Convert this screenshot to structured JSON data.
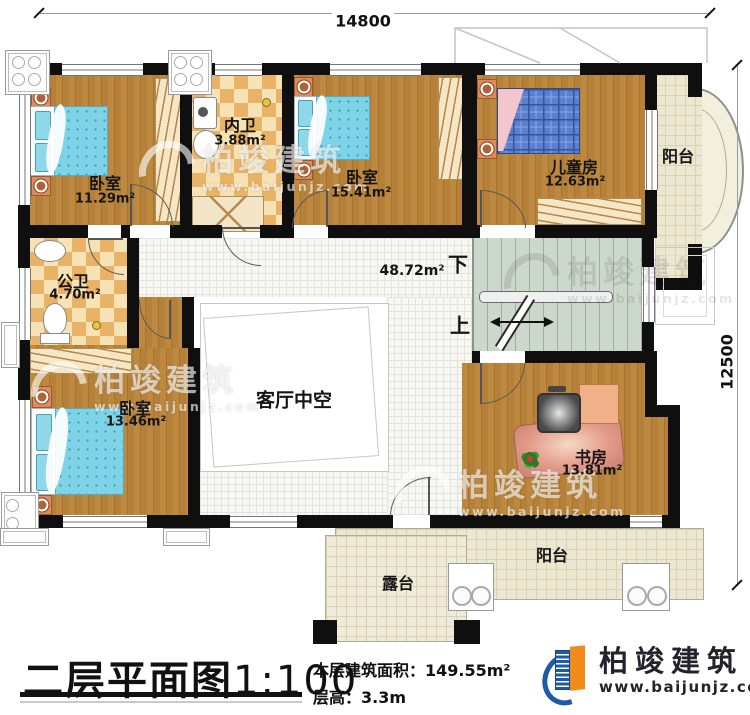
{
  "dimensions": {
    "width_mm": "14800",
    "height_mm": "12500"
  },
  "rooms": {
    "bedroom1": {
      "name": "卧室",
      "area": "11.29m²"
    },
    "inner_bath": {
      "name": "内卫",
      "area": "3.88m²"
    },
    "bedroom2": {
      "name": "卧室",
      "area": "15.41m²"
    },
    "kids_room": {
      "name": "儿童房",
      "area": "12.63m²"
    },
    "balcony_right": {
      "name": "阳台"
    },
    "public_bath": {
      "name": "公卫",
      "area": "4.70m²"
    },
    "bedroom3": {
      "name": "卧室",
      "area": "13.46m²"
    },
    "hall": {
      "area": "48.72m²"
    },
    "living_void": {
      "name": "客厅中空"
    },
    "study": {
      "name": "书房",
      "area": "13.81m²"
    },
    "balcony_bottom": {
      "name": "阳台"
    },
    "terrace": {
      "name": "露台"
    }
  },
  "stairs": {
    "down_label": "下",
    "up_label": "上"
  },
  "title_block": {
    "title": "二层平面图",
    "scale": "1:100",
    "area_label": "本层建筑面积：",
    "area_value": "149.55m²",
    "height_label": "层高：",
    "height_value": "3.3m"
  },
  "brand": {
    "name": "柏竣建筑",
    "website": "www.baijunjz.com"
  },
  "watermark": {
    "name": "柏竣建筑",
    "website": "www.baijunjz.com"
  },
  "colors": {
    "brand_blue": "#1e5aa8",
    "brand_orange": "#f28a1c",
    "wall": "#0f0f0f",
    "bed": "#7ed3e6"
  }
}
